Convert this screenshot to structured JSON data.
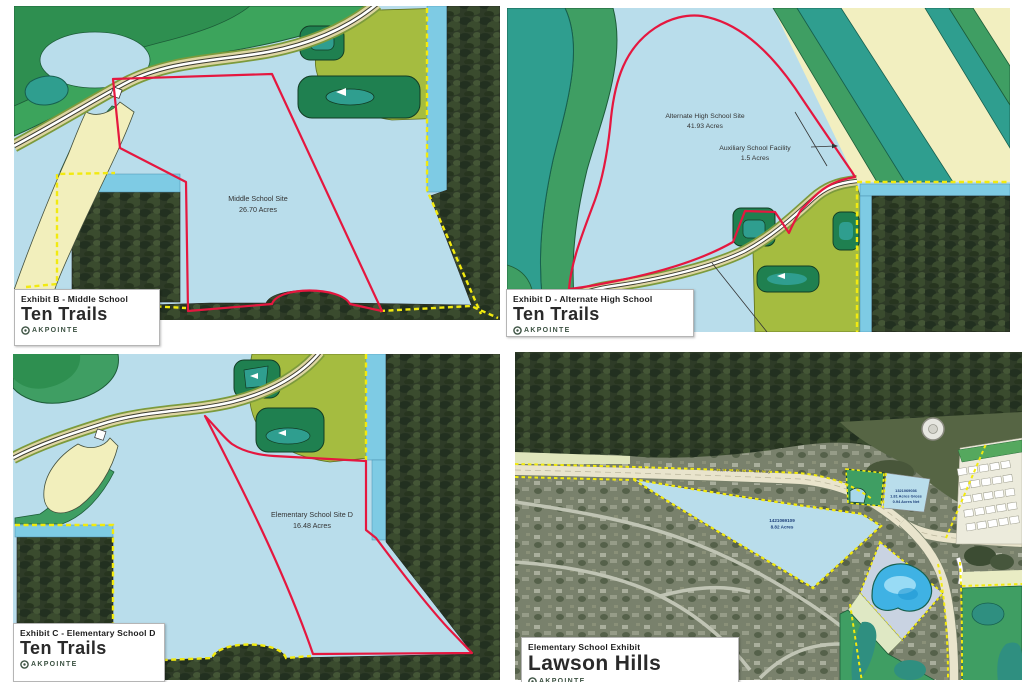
{
  "panels": [
    {
      "exhibit_label": "Exhibit B - Middle School",
      "community": "Ten Trails",
      "logo_text": "AKPOINTE",
      "site_label": "Middle School Site",
      "site_acreage": "26.70 Acres"
    },
    {
      "exhibit_label": "Exhibit D - Alternate High School",
      "community": "Ten Trails",
      "logo_text": "AKPOINTE",
      "site_label": "Alternate High School Site",
      "site_acreage": "41.93 Acres",
      "callout_label": "Auxiliary School Facility",
      "callout_acreage": "1.5 Acres"
    },
    {
      "exhibit_label": "Exhibit C - Elementary School D",
      "community": "Ten Trails",
      "logo_text": "AKPOINTE",
      "site_label": "Elementary School Site D",
      "site_acreage": "16.48 Acres"
    },
    {
      "exhibit_label": "Elementary School Exhibit",
      "community": "Lawson Hills",
      "logo_text": "AKPOINTE",
      "road_label": "Future Lawson Parkway",
      "main_parcel": {
        "parcel_number": "1421069109",
        "acreage": "8.82 Acres"
      },
      "adjacent_parcel": {
        "parcel_number": "1321069036",
        "gross": "1.81 Acres Gross",
        "net": "0.94 Acres Net"
      }
    }
  ],
  "colors": {
    "parcel_boundary_red": "#e5173f",
    "boundary_yellow": "#f2ea0f",
    "site_blue": "#b9ddeb",
    "channel_blue": "#7ecbe4",
    "wetland_teal": "#2f9e8f",
    "open_space_green": "#3f9e63",
    "dark_green_tract": "#1f8050",
    "buffer_olive": "#a5bc40",
    "road_cream": "#f2efbc",
    "logo_green": "#3c5242"
  }
}
